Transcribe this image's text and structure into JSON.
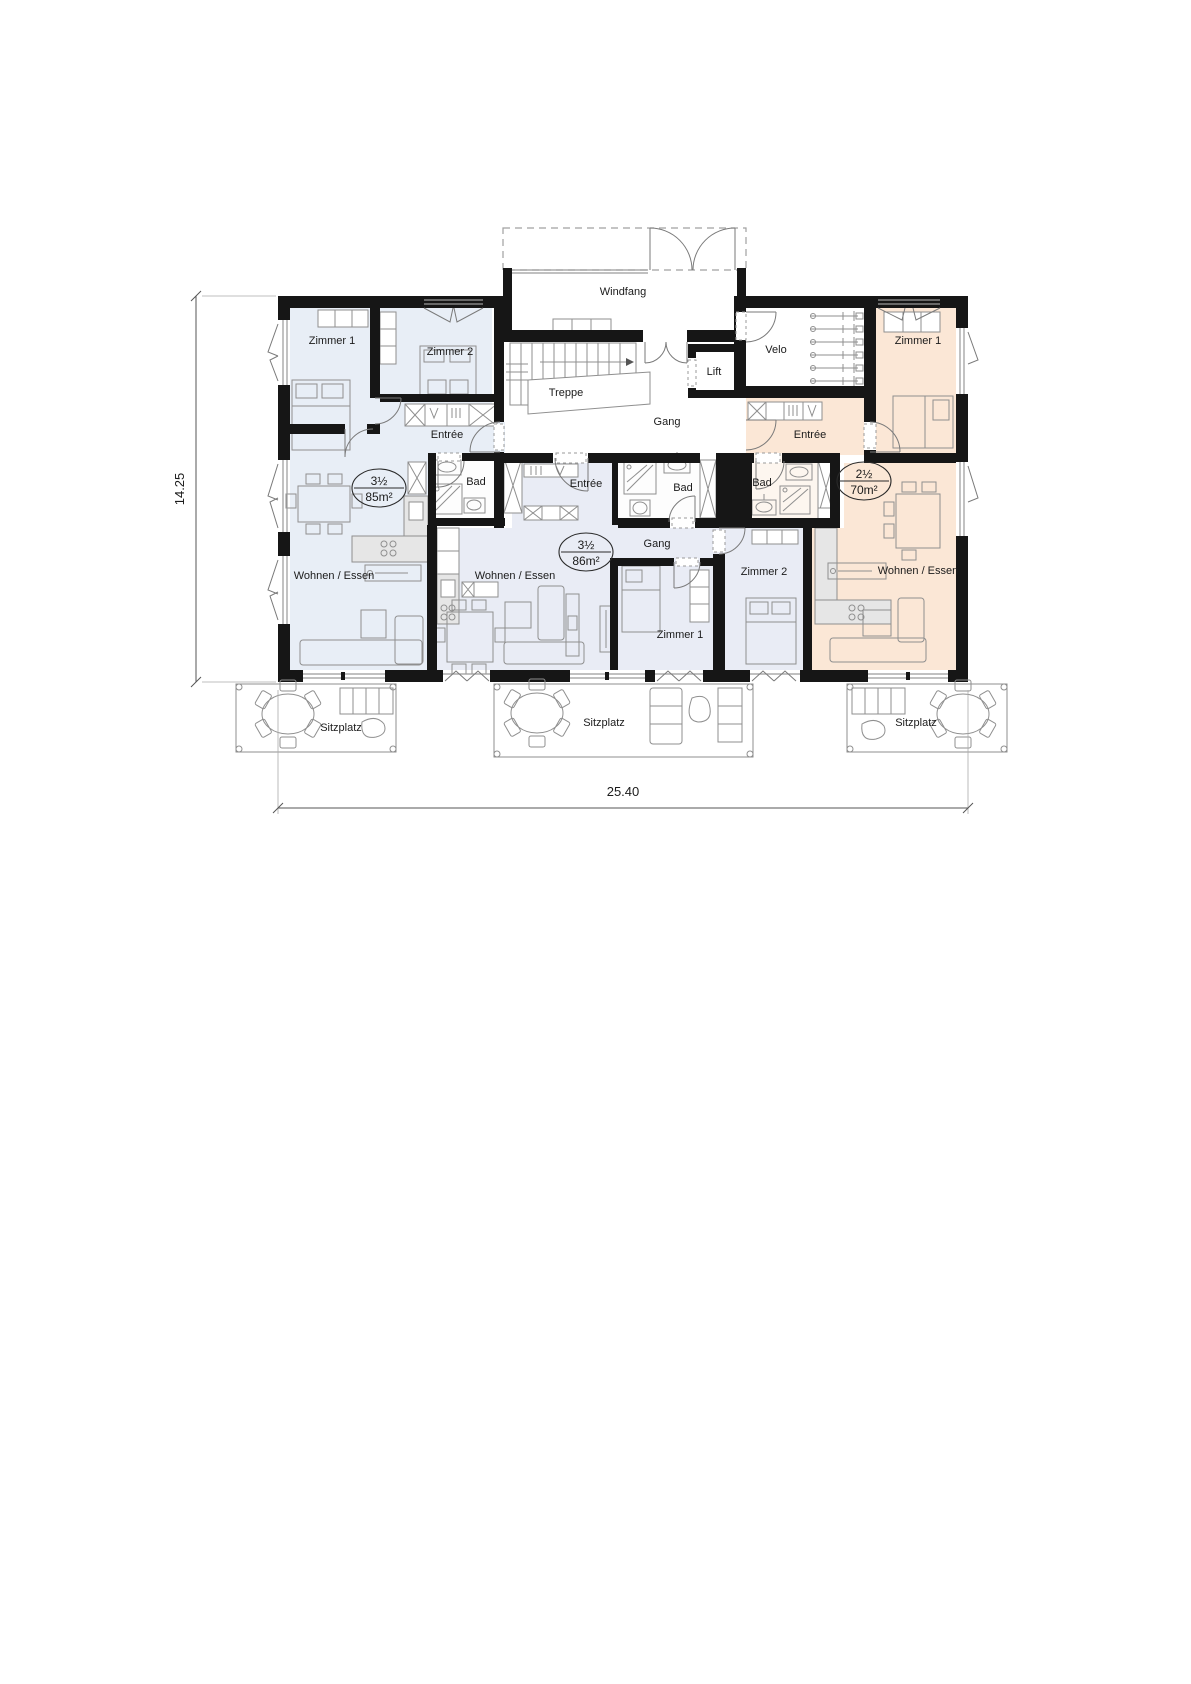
{
  "plan": {
    "core": {
      "windfang": "Windfang",
      "treppe": "Treppe",
      "gang": "Gang",
      "lift": "Lift",
      "velo": "Velo"
    },
    "apartments": [
      {
        "name": "left",
        "type": "3½",
        "area": "85m²",
        "rooms": {
          "zimmer1": "Zimmer 1",
          "zimmer2": "Zimmer 2",
          "entree": "Entrée",
          "bad": "Bad",
          "wohnen": "Wohnen / Essen"
        }
      },
      {
        "name": "middle",
        "type": "3½",
        "area": "86m²",
        "rooms": {
          "entree": "Entrée",
          "bad": "Bad",
          "gang": "Gang",
          "zimmer1": "Zimmer 1",
          "zimmer2": "Zimmer 2",
          "wohnen": "Wohnen / Essen"
        }
      },
      {
        "name": "right",
        "type": "2½",
        "area": "70m²",
        "rooms": {
          "zimmer1": "Zimmer 1",
          "entree": "Entrée",
          "bad": "Bad",
          "wohnen": "Wohnen / Essen"
        }
      }
    ],
    "terraces": [
      {
        "label": "Sitzplatz"
      },
      {
        "label": "Sitzplatz"
      },
      {
        "label": "Sitzplatz"
      }
    ],
    "dimensions": {
      "height": "14.25",
      "width": "25.40"
    },
    "colors": {
      "apartment_left": "#e8eef6",
      "apartment_middle": "#e9ecf5",
      "apartment_right": "#fbe7d6",
      "walls": "#161616"
    }
  }
}
